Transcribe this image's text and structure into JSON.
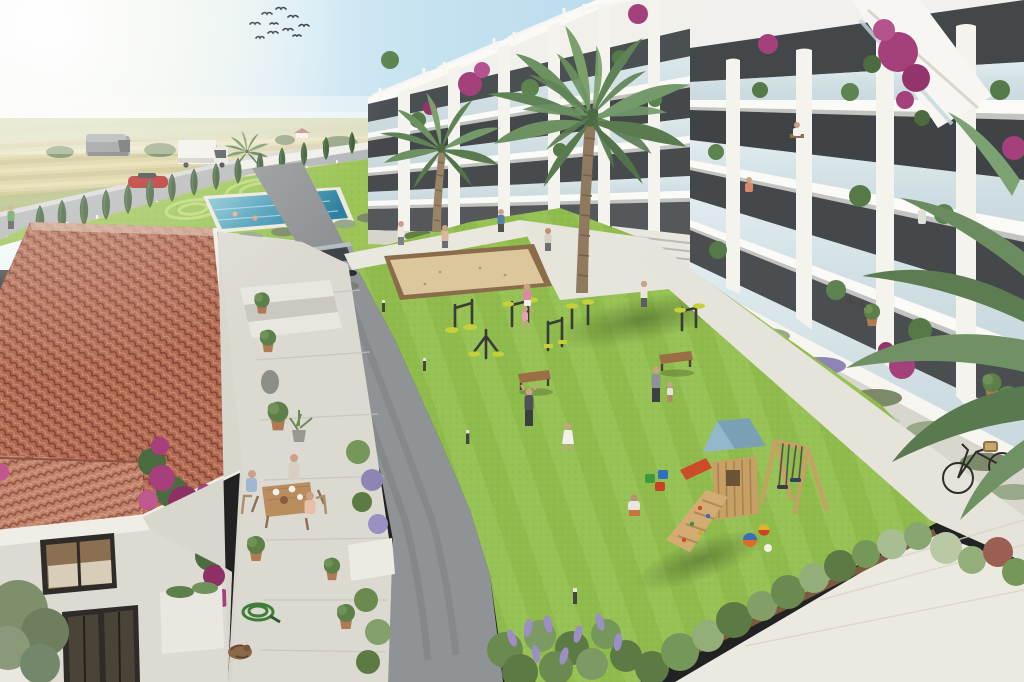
{
  "image": {
    "type": "architectural-render-aerial",
    "title": "Aerial rendering of a Mediterranean residential complex courtyard",
    "scene_elements": [
      "sky-with-sun-glare",
      "bird-flock",
      "farm-fields",
      "country-road",
      "delivery-van",
      "box-truck",
      "red-car",
      "silver-suv",
      "cypress-hedge",
      "swimming-pool",
      "pool-lawn",
      "modern-apartment-block-far",
      "modern-apartment-block-right",
      "rooftop-pergolas",
      "glass-balconies",
      "bougainvillea",
      "palm-trees",
      "central-lawn",
      "petanque-sand-pit",
      "outdoor-gym-equipment",
      "wooden-benches",
      "playground-tower",
      "swing-set",
      "toy-buckets",
      "balls",
      "spanish-house-tile-roof",
      "terrace-dining-family",
      "potted-plants",
      "garden-hose",
      "sleeping-cat",
      "lavender-border",
      "shrub-border",
      "bicycle",
      "stone-paths",
      "residents-walking"
    ],
    "people_count_approx": 22,
    "palette": {
      "sky_left": "#e9f5fb",
      "sky_right": "#a7d2e8",
      "field": "#d8cf9e",
      "road": "#b4b7b9",
      "asphalt": "#909395",
      "lawn": "#8fbb4d",
      "pool_lawn": "#9cc457",
      "pool_water": "#3f93b0",
      "path_white": "#eae7de",
      "building_white": "#f2f1ec",
      "glazing": "#3e4244",
      "glass_rail": "#bdd4de",
      "roof_tile": "#b06952",
      "terrace_stone": "#d9d6ce",
      "bougainvillea": "#a4417d",
      "cypress": "#3d5c37",
      "playground_roof": "#93b7cb",
      "playground_wood": "#c7a066",
      "gym_accent": "#c5d13a",
      "lavender": "#9b8fc4",
      "sand": "#dcc79c"
    }
  }
}
